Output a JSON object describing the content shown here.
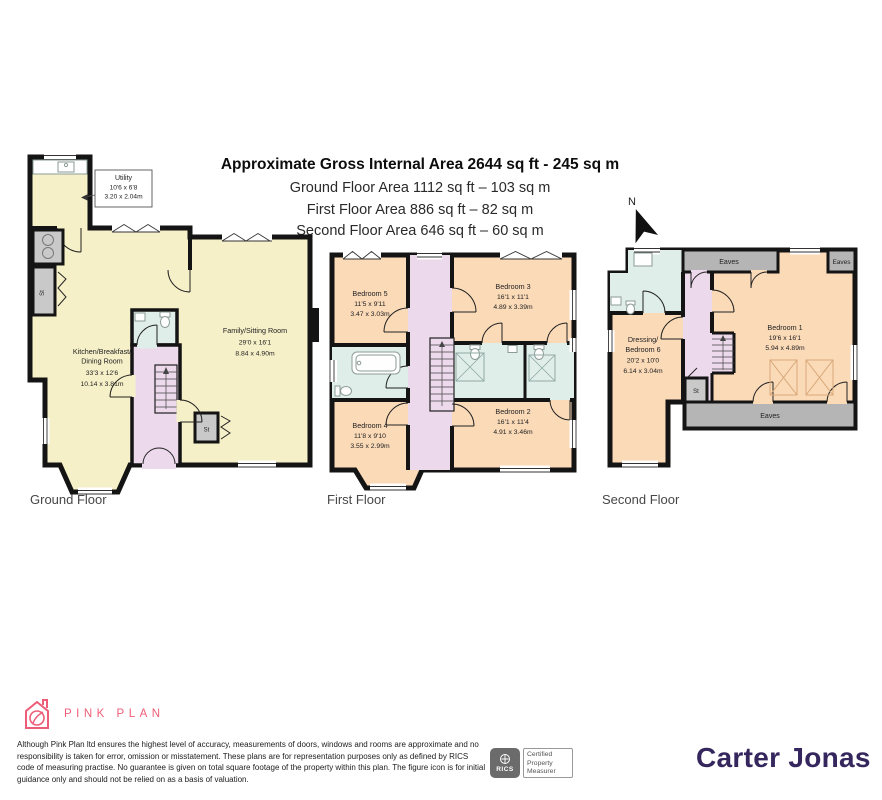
{
  "header": {
    "title": "Approximate Gross Internal Area 2644 sq ft - 245 sq m",
    "subtitle_ground": "Ground Floor Area 1112 sq ft – 103 sq m",
    "subtitle_first": "First Floor Area 886 sq ft – 82 sq m",
    "subtitle_second": "Second Floor Area 646 sq ft – 60 sq m",
    "compass_label": "N"
  },
  "floors": {
    "ground": {
      "label": "Ground Floor",
      "utility": {
        "name": "Utility",
        "imperial": "10'6 x 6'8",
        "metric": "3.20 x 2.04m"
      },
      "kitchen": {
        "name_line1": "Kitchen/Breakfast/",
        "name_line2": "Dining Room",
        "imperial": "33'3 x 12'6",
        "metric": "10.14 x 3.81m"
      },
      "family": {
        "name": "Family/Sitting Room",
        "imperial": "29'0 x 16'1",
        "metric": "8.84 x 4.90m"
      },
      "store_left": "St",
      "store_hall": "St"
    },
    "first": {
      "label": "First Floor",
      "bedroom5": {
        "name": "Bedroom 5",
        "imperial": "11'5 x 9'11",
        "metric": "3.47 x 3.03m"
      },
      "bedroom3": {
        "name": "Bedroom 3",
        "imperial": "16'1 x 11'1",
        "metric": "4.89 x 3.39m"
      },
      "bedroom4": {
        "name": "Bedroom 4",
        "imperial": "11'8 x 9'10",
        "metric": "3.55 x 2.99m"
      },
      "bedroom2": {
        "name": "Bedroom 2",
        "imperial": "16'1 x 11'4",
        "metric": "4.91 x 3.46m"
      }
    },
    "second": {
      "label": "Second Floor",
      "bedroom1": {
        "name": "Bedroom 1",
        "imperial": "19'6 x 16'1",
        "metric": "5.94 x 4.89m"
      },
      "bedroom6": {
        "name_line1": "Dressing/",
        "name_line2": "Bedroom 6",
        "imperial": "20'2 x 10'0",
        "metric": "6.14 x 3.04m"
      },
      "store": "St",
      "eaves_top": "Eaves",
      "eaves_corner": "Eaves",
      "eaves_bottom": "Eaves"
    }
  },
  "footer": {
    "brand": "PINK PLAN",
    "disclaimer": "Although Pink Plan ltd ensures the highest level of accuracy, measurements of doors, windows and rooms are approximate and no responsibility is taken for error, omission or misstatement. These plans are for representation purposes only as defined by RICS code of measuring practise. No guarantee is given on total square footage of the property within this plan. The figure icon is for initial guidance only and should not be relied on as a basis of valuation.",
    "rics_label": "RICS",
    "certified_line1": "Certified",
    "certified_line2": "Property",
    "certified_line3": "Measurer",
    "agent": "Carter Jonas"
  },
  "colors": {
    "wall": "#141414",
    "room_yellow": "#f6f0c8",
    "room_peach": "#fbdab8",
    "hall_lilac": "#ecd9ec",
    "bath_blue": "#dfeee9",
    "eaves_gray": "#b5b5b5",
    "closet_gray": "#c9c9c9",
    "brand_pink": "#ee5d77",
    "agent_purple": "#35265e"
  }
}
